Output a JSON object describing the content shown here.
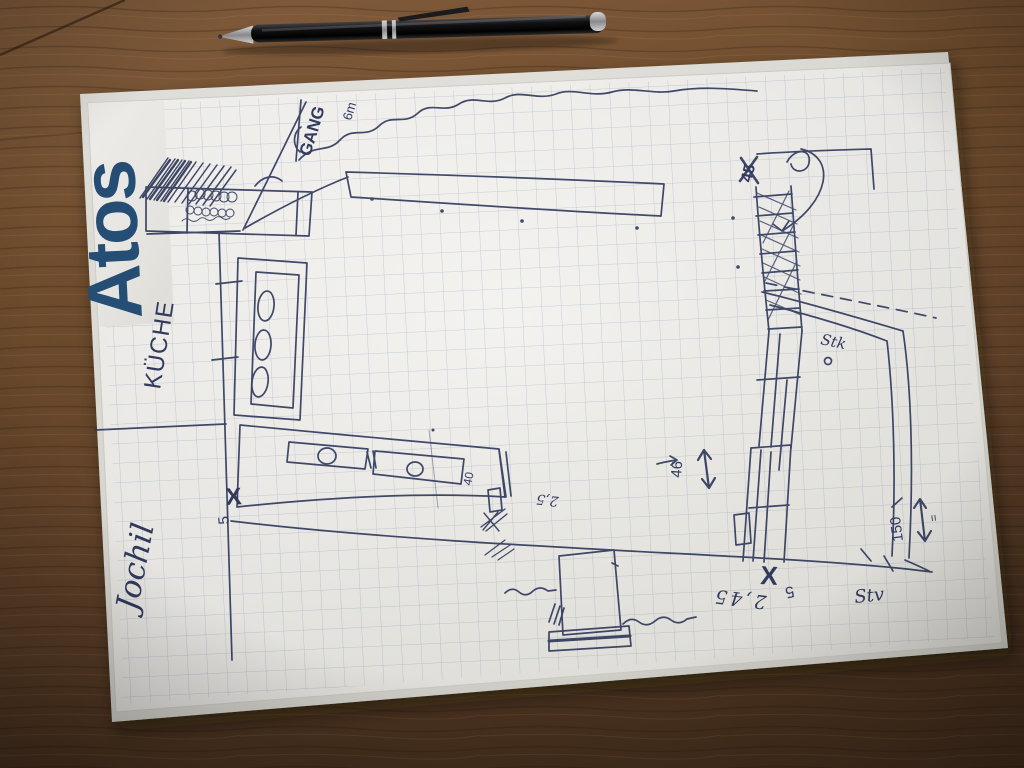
{
  "labels": {
    "brand": "Atos",
    "gang": "GANG",
    "gang_size": "6m",
    "kueche": "KÜCHE",
    "signature": "Jochil",
    "top_right": "45",
    "stairs_width": "46",
    "wall_note": "Stk",
    "depth": "150",
    "depth_eq": "=",
    "bottom_x": "X",
    "bottom_five": "5",
    "bottom_len": "2,45",
    "bottom_note": "Stv",
    "counter_x": "X",
    "counter_five": "5",
    "counter_end": "40",
    "counter_depth": "2,5"
  },
  "colors": {
    "ink": "#333c60",
    "logo": "#27517a",
    "paper": "#f4f3ef",
    "grid": "#9aa9c6",
    "wood": "#6d4c2f"
  }
}
